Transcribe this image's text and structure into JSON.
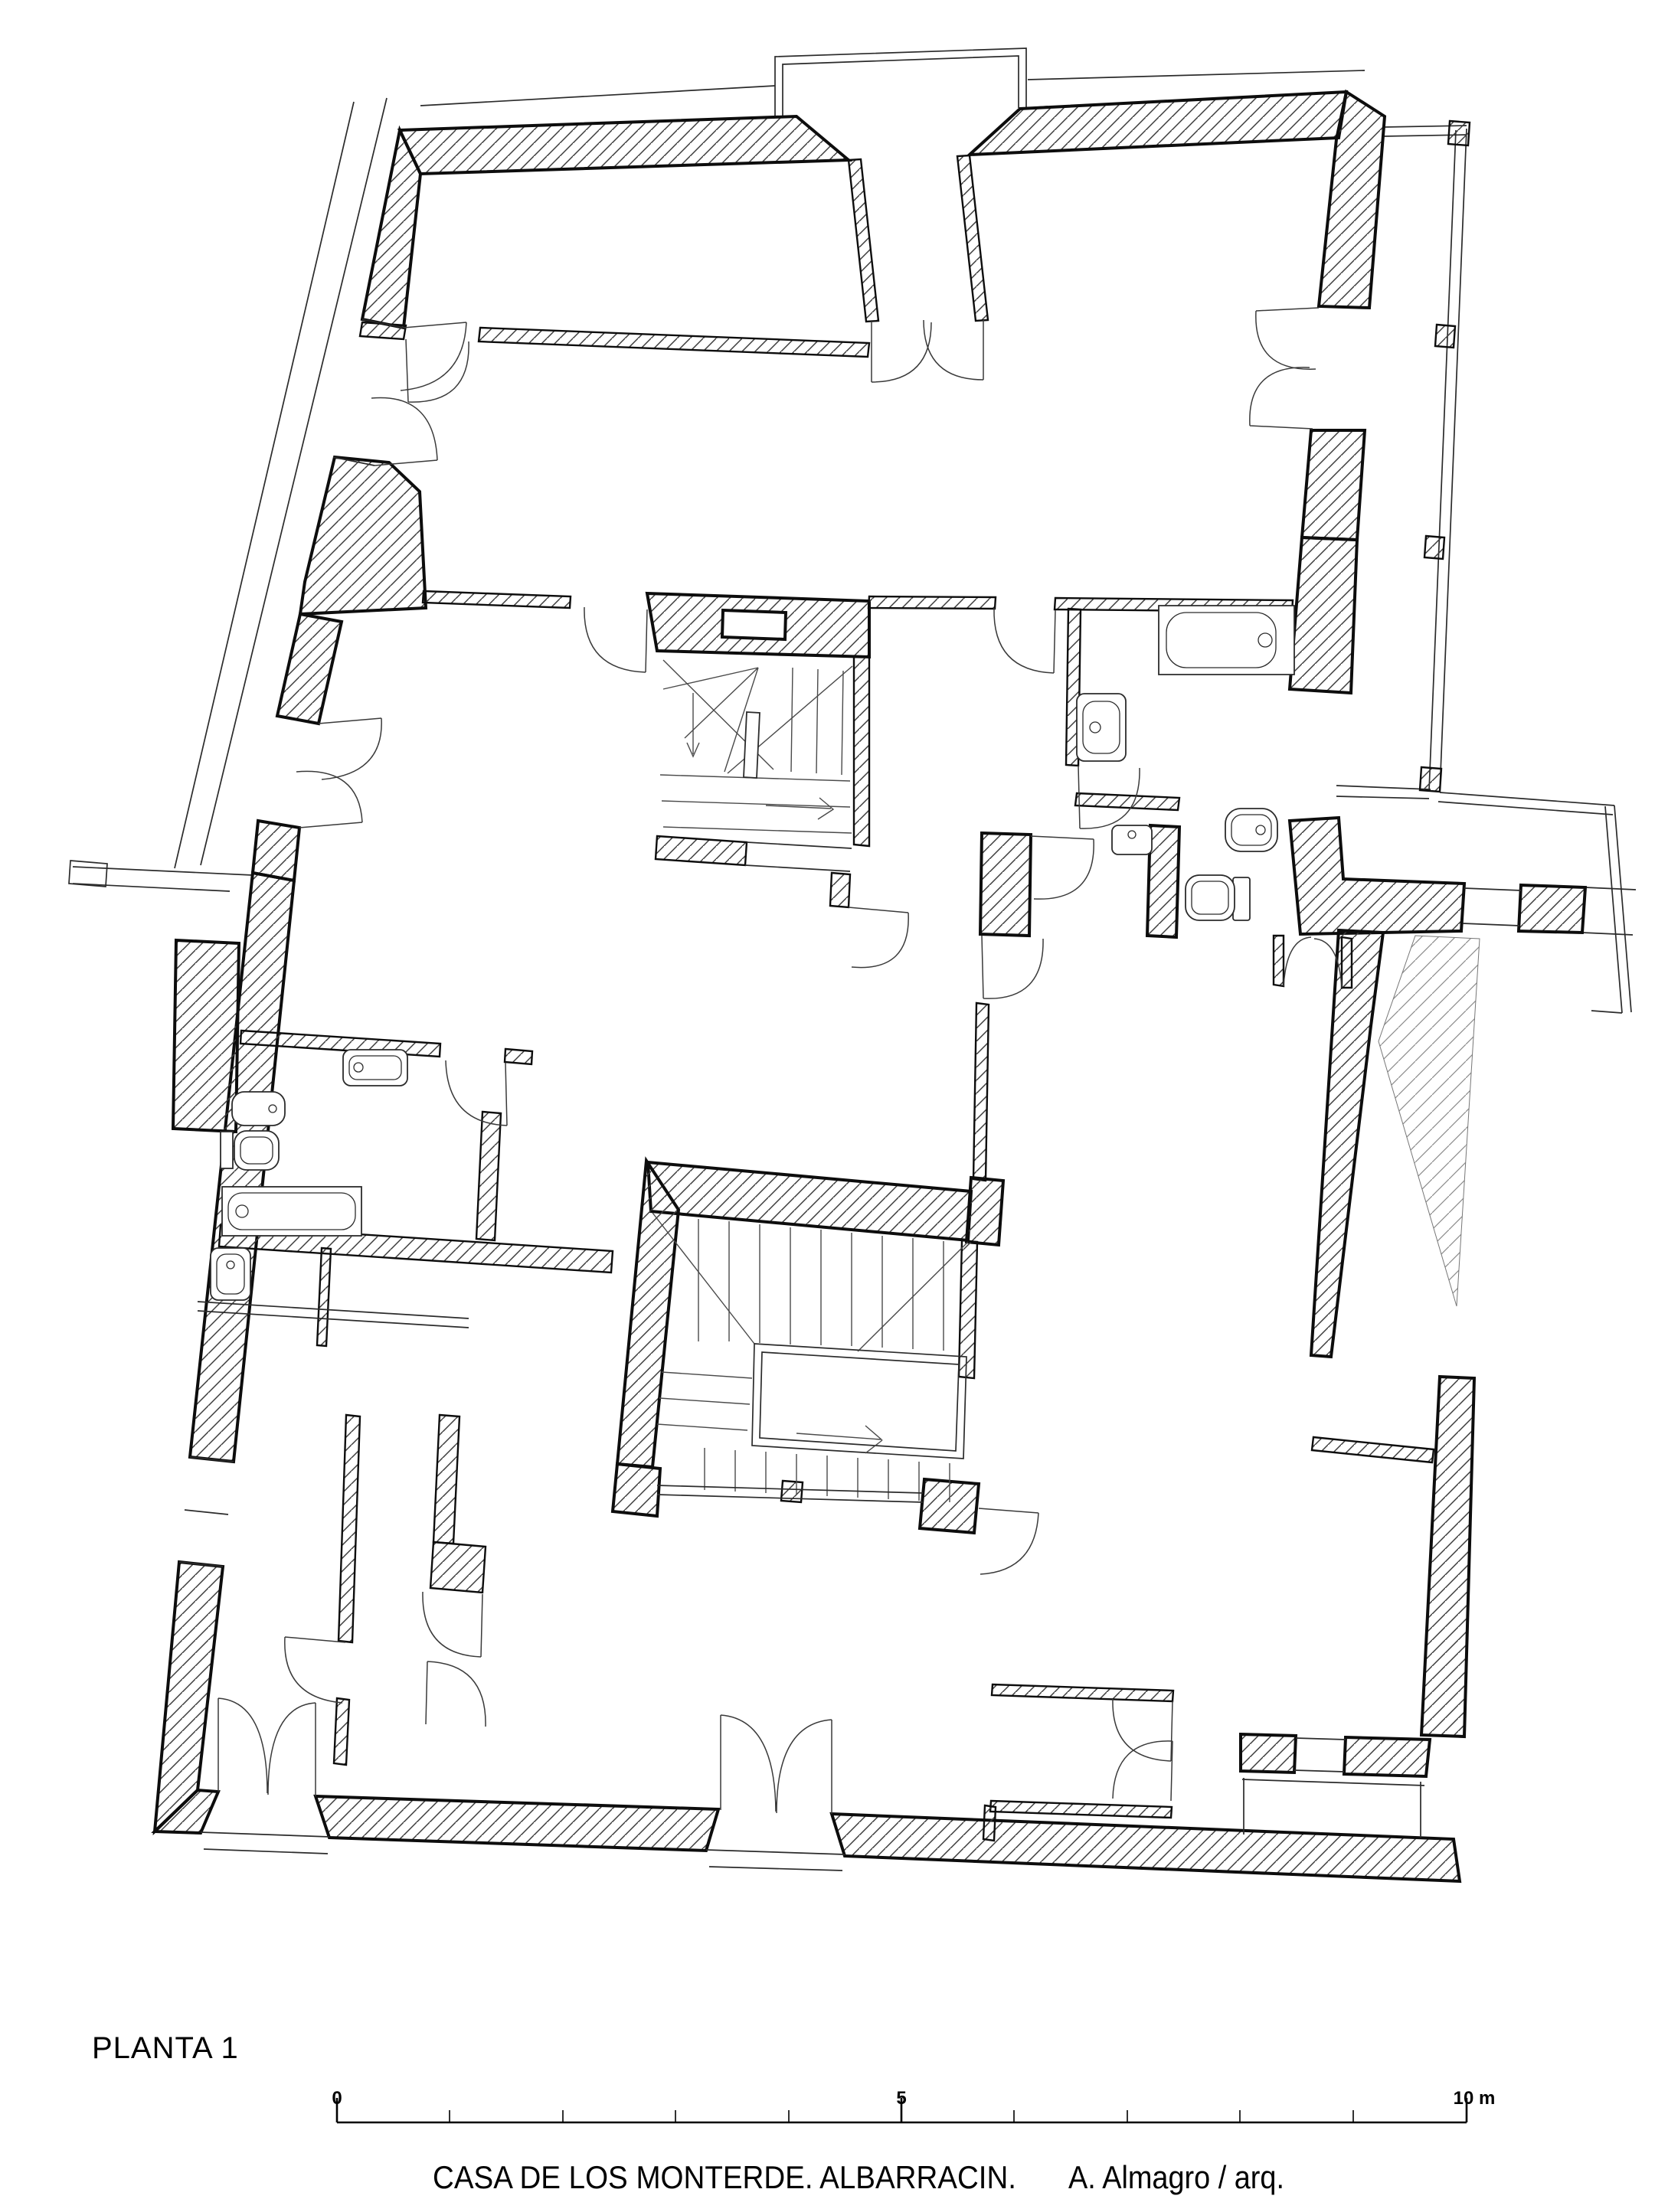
{
  "page": {
    "background": "#ffffff",
    "ink": "#0d0d0d"
  },
  "plan": {
    "floor_label": "PLANTA 1",
    "caption_project": "CASA DE LOS MONTERDE. ALBARRACIN.",
    "caption_author": "A. Almagro / arq.",
    "scale_bar": {
      "zero": "0",
      "five": "5",
      "ten": "10 m"
    }
  },
  "depicted_contents": {
    "building": "two-storey town house, first floor plan",
    "staircases": 2,
    "bathtubs": 2,
    "sinks": 4,
    "toilets": 2,
    "bidets": 2,
    "balconies": 2,
    "double_entry_doors": 3
  }
}
